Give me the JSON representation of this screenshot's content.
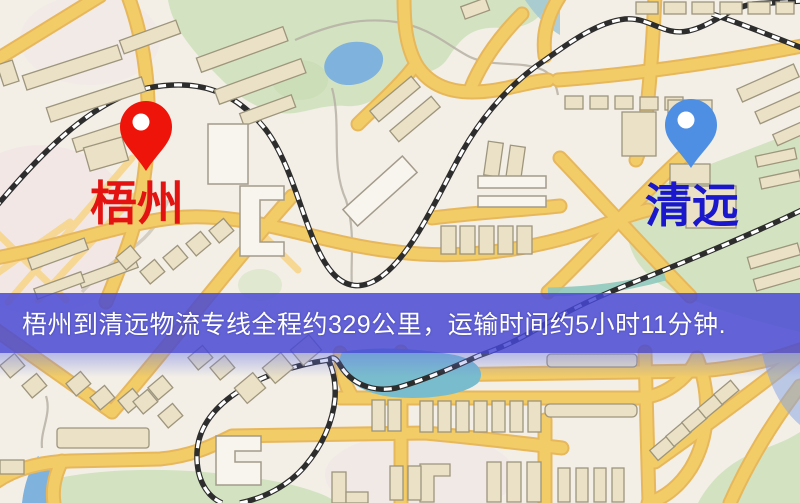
{
  "map": {
    "type": "road-map",
    "origin": {
      "name": "梧州",
      "label_color": "#e21310",
      "pin_color": "#ee1409",
      "pin_icon": "red-map-pin"
    },
    "destination": {
      "name": "清远",
      "label_color": "#1a17cc",
      "pin_color": "#4e8fe4",
      "pin_icon": "blue-map-pin"
    }
  },
  "route": {
    "from": "梧州",
    "to": "清远",
    "service": "物流专线",
    "distance_km": 329,
    "distance_text": "约329公里",
    "duration_text": "约5小时11分钟",
    "duration_hours": 5,
    "duration_minutes": 11
  },
  "banner": {
    "text": "梧州到清远物流专线全程约329公里，运输时间约5小时11分钟.",
    "background_color": "#4848d4",
    "text_color": "#ffffff"
  },
  "palette": {
    "map_background": "#f3efe7",
    "road_yellow": "#f2cc66",
    "road_casing": "#e7b75c",
    "park_green": "#d3e3c1",
    "water_blue": "#7fb2dd",
    "lake_teal": "#79bccd",
    "railway_dark": "#2d2d2d",
    "building_tan": "#eae1c6"
  }
}
